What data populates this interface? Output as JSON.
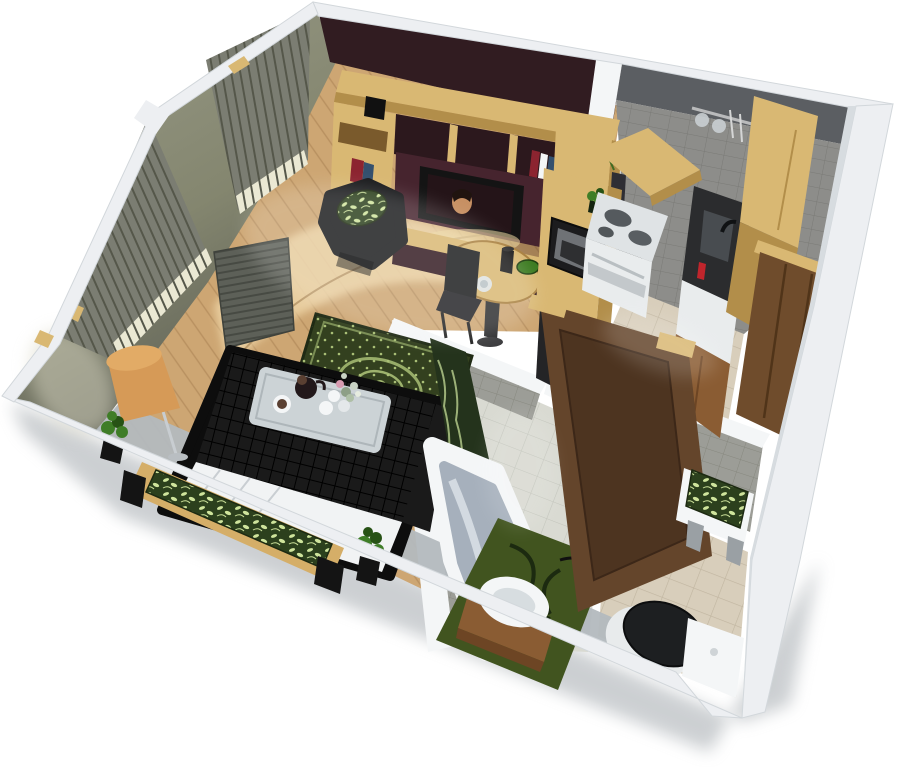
{
  "meta": {
    "type": "3d-apartment-floorplan-render",
    "view": "isometric cutaway, bird's eye, rotated",
    "background": "#ffffff",
    "text_content": "none (image contains no text)"
  },
  "palette": {
    "bg": "#ffffff",
    "wall_outer": "#edeff2",
    "wall_outer_shade": "#d7dce0",
    "wall_face_gray": "#b3b9be",
    "wall_olive": "#8e907e",
    "wall_brown": "#311c21",
    "wall_top_gray": "#5b5e62",
    "tile_wall_gray": "#8d8d8a",
    "tile_wall_light": "#9c9d97",
    "floor_wood": "#cda673",
    "floor_wood_light": "#ecd3a4",
    "floor_tile_beige": "#d8cebb",
    "floor_tile_bath": "#d9dad2",
    "unit_tan": "#d9b873",
    "unit_tan_dark": "#b28e4a",
    "maroon": "#46242e",
    "screen_dark": "#241418",
    "black": "#141414",
    "chair_black": "#1b1c1e",
    "rug_green": "#33401f",
    "rug_light": "#a9bf76",
    "duvet": "#f1f3f4",
    "bench_wood": "#d5ae68",
    "leaf_dark": "#2c401d",
    "leaf_light": "#cfe49c",
    "tray": "#ccd3d6",
    "lamp": "#d69a57",
    "plant": "#3f7d27",
    "plant_dark": "#275215",
    "radiator": "#5d6058",
    "blind": "#7b7d72",
    "blind_gap": "#55574a",
    "blind_tip": "#eae8d3",
    "door_brown": "#64452b",
    "door_panel": "#4d3420",
    "wardrobe": "#6f4c2c",
    "stove_white": "#e9eced",
    "steel": "#c9ced2",
    "counter_dark": "#2b2c2e",
    "cab_wood": "#8a5c33",
    "tub_inner": "#a6b0bc",
    "mat_green": "#41541f",
    "toilet_lid": "#1d1f21",
    "white": "#f4f6f7",
    "skin": "#c79063",
    "book_red": "#8c2430",
    "flower_red": "#c0252c",
    "teal": "#7fb3ac",
    "book_blue": "#34506e",
    "glow": "#ecd9a0"
  },
  "scene": {
    "rooms": [
      {
        "id": "living-bedroom",
        "floor": "hardwood",
        "objects": [
          "vertical-blind-windows",
          "radiator",
          "dark-brown-feature-wall",
          "tan-wall-unit-with-tv",
          "tv",
          "books",
          "desk",
          "black-armchair-with-green-pillow",
          "round-dining-table",
          "black-dining-chair",
          "vase-with-red-flowers",
          "green-oriental-rug",
          "double-bed-black-quilt-white-duvet",
          "breakfast-tray-with-flowers",
          "foot-bench-with-leaf-cushion",
          "floor-lamp",
          "potted-plant-left",
          "potted-plant-right"
        ]
      },
      {
        "id": "kitchen",
        "floor": "beige-tile",
        "objects": [
          "gray-tiled-walls",
          "hanging-utensils",
          "stove",
          "dark-sink-counter",
          "tall-tan-cabinets",
          "wooden-base-cabinets",
          "bar-partition-with-picture",
          "partition-plant"
        ]
      },
      {
        "id": "bathroom",
        "floor": "light-tile",
        "objects": [
          "bathtub",
          "dark-green-shower-curtain",
          "green-bath-mat",
          "washbasin",
          "wooden-vanity-shelf",
          "open-wooden-door"
        ]
      },
      {
        "id": "hallway",
        "floor": "beige-tile",
        "objects": [
          "brown-wardrobe"
        ]
      },
      {
        "id": "wc",
        "floor": "beige-tile",
        "objects": [
          "toilet-black-lid",
          "white-bench-with-leaf-cushion",
          "tiled-back-wall"
        ]
      }
    ]
  }
}
